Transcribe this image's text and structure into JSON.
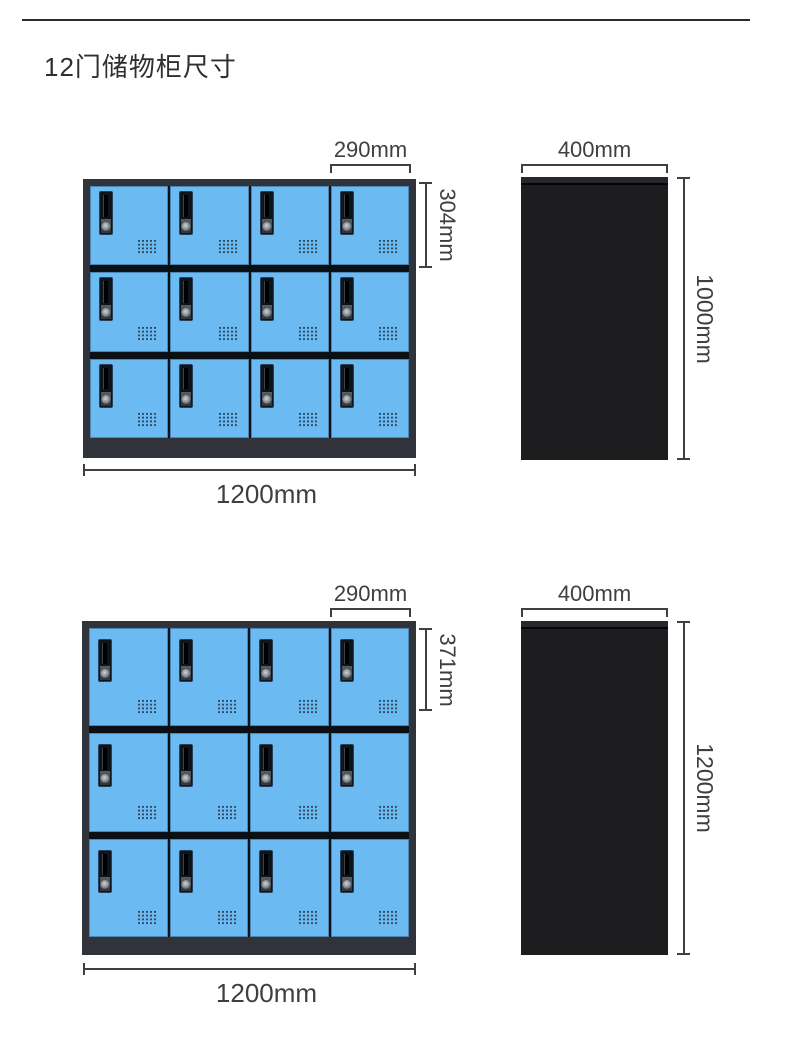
{
  "title": "12门储物柜尺寸",
  "figures": [
    {
      "id": "top-locker",
      "front_view": {
        "rows": 3,
        "columns": 4,
        "doors": 12,
        "door_width": "290mm",
        "door_height": "304mm",
        "overall_width": "1200mm"
      },
      "side_view": {
        "depth": "400mm",
        "height": "1000mm"
      }
    },
    {
      "id": "bottom-locker",
      "front_view": {
        "rows": 3,
        "columns": 4,
        "doors": 12,
        "door_width": "290mm",
        "door_height": "371mm",
        "overall_width": "1200mm"
      },
      "side_view": {
        "depth": "400mm",
        "height": "1200mm"
      }
    }
  ],
  "colors": {
    "door_blue": "#6cbaf2",
    "cabinet_frame": "#303339",
    "door_divider": "#0b1015",
    "side_view_black": "#1d1d20",
    "dimension_gray": "#3f3f3f"
  }
}
